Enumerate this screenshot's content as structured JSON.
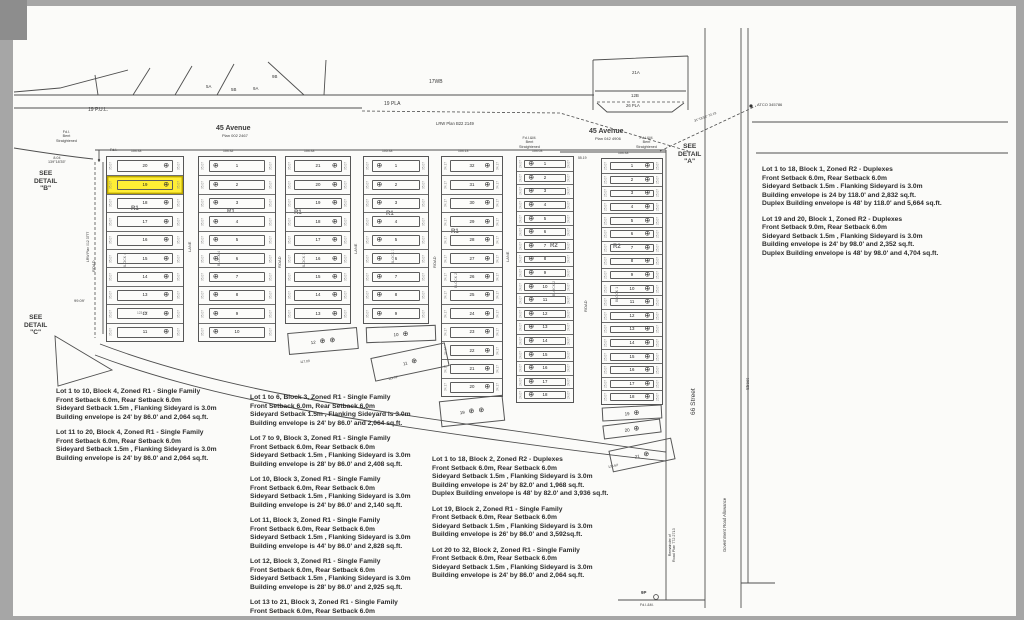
{
  "meta": {
    "document_type": "subdivision plat survey plan",
    "highlight_color": "#ffee35"
  },
  "labels": [
    {
      "t": "19 P.U.L.",
      "x": 88,
      "y": 108,
      "s": 5,
      "n": "road-label-19-pul"
    },
    {
      "t": "19 PLA",
      "x": 384,
      "y": 102,
      "s": 5,
      "n": "road-label-19-pla"
    },
    {
      "t": "LRW Plan B22 2149",
      "x": 436,
      "y": 122,
      "s": 4.2,
      "n": "lrw-plan-label"
    },
    {
      "t": "17WB",
      "x": 429,
      "y": 80,
      "s": 5,
      "n": "parcel-17wb-label"
    },
    {
      "t": "5A",
      "x": 206,
      "y": 84,
      "s": 4.4
    },
    {
      "t": "5B",
      "x": 231,
      "y": 87,
      "s": 4.4
    },
    {
      "t": "9A",
      "x": 253,
      "y": 86,
      "s": 4.4
    },
    {
      "t": "9B",
      "x": 272,
      "y": 74,
      "s": 4.4
    },
    {
      "t": "21A",
      "x": 632,
      "y": 70,
      "s": 4.4
    },
    {
      "t": "12B",
      "x": 631,
      "y": 93,
      "s": 4.4
    },
    {
      "t": "26 PLA",
      "x": 626,
      "y": 104,
      "s": 4.2
    },
    {
      "t": "45 Avenue",
      "x": 216,
      "y": 125,
      "s": 7,
      "w": 700,
      "n": "avenue-45-west-label"
    },
    {
      "t": "Plan 002 2467",
      "x": 222,
      "y": 134,
      "s": 4,
      "n": "avenue-45-west-plan"
    },
    {
      "t": "45 Avenue",
      "x": 589,
      "y": 128,
      "s": 7,
      "w": 700,
      "n": "avenue-45-east-label"
    },
    {
      "t": "Plan 042 4906",
      "x": 595,
      "y": 137,
      "s": 4,
      "n": "avenue-45-east-plan"
    },
    {
      "t": "Fd.I.\nBent\nStraightened",
      "x": 56,
      "y": 130,
      "s": 3.7
    },
    {
      "t": "Fd.I.&M.\nBent\nStraightened",
      "x": 519,
      "y": 136,
      "s": 3.7
    },
    {
      "t": "Fd.I.&M.\nBent\nStraightened",
      "x": 636,
      "y": 136,
      "s": 3.7
    },
    {
      "t": "Fd.I.",
      "x": 110,
      "y": 148,
      "s": 3.7
    },
    {
      "t": "8.04\n139°18'35\"",
      "x": 48,
      "y": 156,
      "s": 3.7
    },
    {
      "t": "SEE\nDETAIL\n\"B\"",
      "x": 34,
      "y": 170,
      "s": 6.6,
      "w": 700,
      "n": "see-detail-b-label"
    },
    {
      "t": "SEE\nDETAIL\n\"C\"",
      "x": 24,
      "y": 314,
      "s": 6.6,
      "w": 700,
      "n": "see-detail-c-label"
    },
    {
      "t": "SEE\nDETAIL\n\"A\"",
      "x": 678,
      "y": 143,
      "s": 6.6,
      "w": 700,
      "n": "see-detail-a-label"
    },
    {
      "t": "ATCO 345786",
      "x": 757,
      "y": 103,
      "s": 4,
      "n": "atco-marker-label"
    },
    {
      "t": "31°18'58\"  72.19",
      "x": 694,
      "y": 120,
      "s": 3.3,
      "r": -20
    },
    {
      "t": "66 Street",
      "x": 690,
      "y": 415,
      "s": 6.6,
      "r": -90,
      "n": "street-66-label"
    },
    {
      "t": "Government Road Allowance",
      "x": 723,
      "y": 552,
      "s": 4.2,
      "r": -90,
      "n": "government-road-allowance-label"
    },
    {
      "t": "Street",
      "x": 745,
      "y": 390,
      "s": 4.4,
      "r": -90
    },
    {
      "t": "Remainder of\nRoad Plan 772 2713",
      "x": 668,
      "y": 562,
      "s": 3.7,
      "r": -90,
      "n": "road-plan-remainder-label"
    },
    {
      "t": "9P",
      "x": 641,
      "y": 590,
      "s": 4.4,
      "w": 700
    },
    {
      "t": "Fd.I.&M.",
      "x": 640,
      "y": 603,
      "s": 3.6
    },
    {
      "t": "99.09'",
      "x": 74,
      "y": 299,
      "s": 4
    },
    {
      "t": "R1",
      "x": 131,
      "y": 206,
      "s": 6,
      "w": 700,
      "n": "zone-r1-label"
    },
    {
      "t": "R1",
      "x": 227,
      "y": 209,
      "s": 6,
      "w": 700,
      "n": "zone-r1-label"
    },
    {
      "t": "R1",
      "x": 294,
      "y": 210,
      "s": 6,
      "w": 700,
      "n": "zone-r1-label"
    },
    {
      "t": "R1",
      "x": 386,
      "y": 211,
      "s": 6,
      "w": 700,
      "n": "zone-r1-label"
    },
    {
      "t": "R1",
      "x": 451,
      "y": 229,
      "s": 6,
      "w": 700,
      "n": "zone-r1-label"
    },
    {
      "t": "R2",
      "x": 550,
      "y": 243,
      "s": 6,
      "w": 700,
      "n": "zone-r2-label"
    },
    {
      "t": "R2",
      "x": 613,
      "y": 244,
      "s": 6,
      "w": 700,
      "n": "zone-r2-label"
    },
    {
      "t": "BLOCK 4",
      "x": 123,
      "y": 268,
      "s": 3.6,
      "r": -90
    },
    {
      "t": "BLOCK 4",
      "x": 217,
      "y": 266,
      "s": 3.6,
      "r": -90
    },
    {
      "t": "BLOCK 3",
      "x": 302,
      "y": 268,
      "s": 3.6,
      "r": -90
    },
    {
      "t": "BLOCK 3",
      "x": 391,
      "y": 264,
      "s": 3.6,
      "r": -90
    },
    {
      "t": "BLOCK 2",
      "x": 454,
      "y": 288,
      "s": 3.6,
      "r": -90
    },
    {
      "t": "BLOCK 2",
      "x": 552,
      "y": 296,
      "s": 3.6,
      "r": -90
    },
    {
      "t": "BLOCK 1",
      "x": 615,
      "y": 302,
      "s": 3.6,
      "r": -90
    },
    {
      "t": "LANE",
      "x": 188,
      "y": 252,
      "s": 4,
      "r": -90
    },
    {
      "t": "LANE",
      "x": 354,
      "y": 254,
      "s": 4,
      "r": -90
    },
    {
      "t": "LANE",
      "x": 506,
      "y": 262,
      "s": 4,
      "r": -90
    },
    {
      "t": "ROAD",
      "x": 92,
      "y": 272,
      "s": 4,
      "r": -90
    },
    {
      "t": "ROAD",
      "x": 278,
      "y": 268,
      "s": 4,
      "r": -90
    },
    {
      "t": "ROAD",
      "x": 433,
      "y": 268,
      "s": 4,
      "r": -90
    },
    {
      "t": "ROAD",
      "x": 584,
      "y": 312,
      "s": 4,
      "r": -90
    },
    {
      "t": "LRW Plan 012 3777",
      "x": 87,
      "y": 262,
      "s": 3.4,
      "r": -90
    },
    {
      "t": "104.33",
      "x": 131,
      "y": 150,
      "s": 3.4
    },
    {
      "t": "104.32",
      "x": 223,
      "y": 150,
      "s": 3.4
    },
    {
      "t": "104.33",
      "x": 304,
      "y": 150,
      "s": 3.4
    },
    {
      "t": "105.33",
      "x": 382,
      "y": 150,
      "s": 3.4
    },
    {
      "t": "104.13",
      "x": 458,
      "y": 150,
      "s": 3.4
    },
    {
      "t": "104.03",
      "x": 532,
      "y": 150,
      "s": 3.4
    },
    {
      "t": "104.33",
      "x": 618,
      "y": 152,
      "s": 3.4
    },
    {
      "t": "55.19",
      "x": 578,
      "y": 157,
      "s": 3.4
    },
    {
      "t": "117.03'",
      "x": 300,
      "y": 361,
      "s": 3.2,
      "r": -6
    },
    {
      "t": "111.02'",
      "x": 388,
      "y": 378,
      "s": 3.2,
      "r": -13
    },
    {
      "t": "136.62'",
      "x": 608,
      "y": 466,
      "s": 3.2,
      "r": -12
    },
    {
      "t": "123.79'",
      "x": 137,
      "y": 312,
      "s": 3.2
    },
    {
      "t": "103.59'",
      "x": 137,
      "y": 177,
      "s": 3.2
    }
  ],
  "blocks": [
    {
      "name": "block-4-west",
      "x": 106,
      "y": 156,
      "w": 78,
      "rh": 18.4,
      "sym": "right",
      "hl": 1,
      "sd": "35.07",
      "lots": [
        "20",
        "19",
        "18",
        "17",
        "16",
        "15",
        "14",
        "13",
        "12",
        "11"
      ]
    },
    {
      "name": "block-4-east",
      "x": 198,
      "y": 156,
      "w": 78,
      "rh": 18.4,
      "sym": "left",
      "hl": -1,
      "sd": "35.07",
      "lots": [
        "1",
        "2",
        "3",
        "4",
        "5",
        "6",
        "7",
        "8",
        "9",
        "10"
      ]
    },
    {
      "name": "block-3-west",
      "x": 285,
      "y": 156,
      "w": 66,
      "rh": 18.4,
      "sym": "right",
      "hl": -1,
      "sd": "35.07",
      "lots": [
        "21",
        "20",
        "19",
        "18",
        "17",
        "16",
        "15",
        "14",
        "13"
      ]
    },
    {
      "name": "block-3-east",
      "x": 363,
      "y": 156,
      "w": 66,
      "rh": 18.4,
      "sym": "left",
      "hl": -1,
      "sd": "35.07",
      "lots": [
        "1",
        "2",
        "3",
        "4",
        "5",
        "6",
        "7",
        "8",
        "9"
      ]
    },
    {
      "name": "block-2-west",
      "x": 441,
      "y": 156,
      "w": 62,
      "rh": 18.4,
      "sym": "right",
      "hl": -1,
      "sd": "34.17",
      "lots": [
        "32",
        "31",
        "30",
        "29",
        "28",
        "27",
        "26",
        "25",
        "24",
        "23",
        "22",
        "21",
        "20"
      ]
    },
    {
      "name": "block-2-east",
      "x": 516,
      "y": 156,
      "w": 58,
      "rh": 13.6,
      "sym": "left",
      "hl": -1,
      "sd": "24.07",
      "lots": [
        "1",
        "2",
        "3",
        "4",
        "5",
        "6",
        "7",
        "8",
        "9",
        "10",
        "11",
        "12",
        "13",
        "14",
        "15",
        "16",
        "17",
        "18"
      ]
    },
    {
      "name": "block-1",
      "x": 601,
      "y": 158,
      "w": 62,
      "rh": 13.6,
      "sym": "right",
      "hl": -1,
      "sd": "25.07",
      "lots": [
        "1",
        "2",
        "3",
        "4",
        "5",
        "6",
        "7",
        "8",
        "9",
        "10",
        "11",
        "12",
        "13",
        "14",
        "15",
        "16",
        "17",
        "18"
      ]
    }
  ],
  "angled_lots": [
    {
      "name": "lot-12-block-3",
      "label": "12",
      "x": 288,
      "y": 330,
      "w": 70,
      "h": 22,
      "r": -5,
      "syms": 2
    },
    {
      "name": "lot-10-block-3",
      "label": "10",
      "x": 366,
      "y": 326,
      "w": 70,
      "h": 16,
      "r": -2,
      "syms": 1
    },
    {
      "name": "lot-11-block-3",
      "label": "11",
      "x": 372,
      "y": 350,
      "w": 76,
      "h": 24,
      "r": -12,
      "syms": 1
    },
    {
      "name": "lot-19-block-2",
      "label": "19",
      "x": 440,
      "y": 398,
      "w": 64,
      "h": 26,
      "r": -6,
      "syms": 2
    },
    {
      "name": "lot-19-block-1",
      "label": "19",
      "x": 602,
      "y": 406,
      "w": 60,
      "h": 14,
      "r": -3,
      "syms": 1
    },
    {
      "name": "lot-20-block-1",
      "label": "20",
      "x": 603,
      "y": 422,
      "w": 58,
      "h": 14,
      "r": -7,
      "syms": 1
    },
    {
      "name": "lot-21-block-1",
      "label": "21",
      "x": 610,
      "y": 444,
      "w": 64,
      "h": 22,
      "r": -12,
      "syms": 1
    }
  ],
  "notes": [
    {
      "x": 56,
      "y": 388,
      "w": 196,
      "n": "notes-block-4",
      "paras": [
        [
          "Lot 1 to 10, Block 4, Zoned R1 - Single Family",
          "Front Setback 6.0m, Rear Setback 6.0m",
          "Sideyard Setback 1.5m , Flanking Sideyard is 3.0m",
          "Building envelope is 24' by 86.0' and 2,064 sq.ft."
        ],
        [
          "Lot 11 to 20, Block 4, Zoned R1 - Single Family",
          "Front Setback 6.0m, Rear Setback 6.0m",
          "Sideyard Setback 1.5m , Flanking Sideyard is 3.0m",
          "Building envelope is 24' by 86.0' and 2,064 sq.ft."
        ]
      ]
    },
    {
      "x": 250,
      "y": 394,
      "w": 198,
      "n": "notes-block-3",
      "paras": [
        [
          "Lot 1 to 6, Block 3, Zoned R1 - Single Family",
          "Front Setback 6.0m, Rear Setback 6.0m",
          "Sideyard Setback 1.5m , Flanking Sideyard is 3.0m",
          "Building envelope is 24' by 86.0' and 2,064 sq.ft."
        ],
        [
          "Lot 7 to 9, Block 3, Zoned R1 - Single Family",
          "Front Setback 6.0m, Rear Setback 6.0m",
          "Sideyard Setback 1.5m , Flanking Sideyard is 3.0m",
          "Building envelope is 28' by 86.0' and 2,408 sq.ft."
        ],
        [
          "Lot 10, Block 3, Zoned R1 - Single Family",
          "Front Setback 6.0m, Rear Setback 6.0m",
          "Sideyard Setback 1.5m , Flanking Sideyard is 3.0m",
          "Building envelope is 24' by 86.0' and 2,140 sq.ft."
        ],
        [
          "Lot 11, Block 3, Zoned R1 - Single Family",
          "Front Setback 6.0m, Rear Setback 6.0m",
          "Sideyard Setback 1.5m , Flanking Sideyard is 3.0m",
          "Building envelope is 44' by 86.0' and 2,828 sq.ft."
        ],
        [
          "Lot 12, Block 3, Zoned R1 - Single Family",
          "Front Setback 6.0m, Rear Setback 6.0m",
          "Sideyard Setback 1.5m , Flanking Sideyard is 3.0m",
          "Building envelope is 28' by 86.0' and 2,925 sq.ft."
        ],
        [
          "Lot 13 to 21, Block 3, Zoned R1 - Single Family",
          "Front Setback 6.0m, Rear Setback 6.0m"
        ]
      ]
    },
    {
      "x": 432,
      "y": 456,
      "w": 204,
      "n": "notes-block-2",
      "paras": [
        [
          "Lot 1 to 18, Block 2, Zoned R2 - Duplexes",
          "Front Setback 6.0m, Rear Setback 6.0m",
          "Sideyard Setback 1.5m , Flanking Sideyard is 3.0m",
          "Building envelope is 24' by 82.0' and 1,968 sq.ft.",
          "Duplex Building envelope is 48' by 82.0' and 3,936 sq.ft."
        ],
        [
          "Lot 19, Block 2, Zoned R1 - Single Family",
          "Front Setback 6.0m, Rear Setback 6.0m",
          "Sideyard Setback 1.5m , Flanking Sideyard is 3.0m",
          "Building envelope is 26' by 86.0' and 3,592sq.ft."
        ],
        [
          "Lot 20 to 32, Block 2, Zoned R1 - Single Family",
          "Front Setback 6.0m, Rear Setback 6.0m",
          "Sideyard Setback 1.5m , Flanking Sideyard is 3.0m",
          "Building envelope is 24' by 86.0' and 2,064 sq.ft."
        ]
      ]
    },
    {
      "x": 762,
      "y": 166,
      "w": 244,
      "n": "notes-block-1",
      "paras": [
        [
          "Lot 1 to 18, Block 1, Zoned R2 - Duplexes",
          "Front Setback 6.0m, Rear Setback 6.0m",
          "Sideyard Setback 1.5m . Flanking Sideyard is 3.0m",
          "Building envelope is 24 by 118.0' and 2,832 sq.ft.",
          "Duplex Building envelope is 48' by 118.0' and 5,664 sq.ft."
        ],
        [
          "Lot 19 and 20, Block 1, Zoned R2 - Duplexes",
          "Front Setback 9.0m, Rear Setback 6.0m",
          "Sideyard Setback 1.5m , Flanking Sideyard is 3.0m",
          "Building envelope is 24' by 98.0' and 2,352 sq.ft.",
          "Duplex Building envelope is 48' by 98.0' and 4,704 sq.ft."
        ]
      ]
    }
  ],
  "symbol": "⊕"
}
